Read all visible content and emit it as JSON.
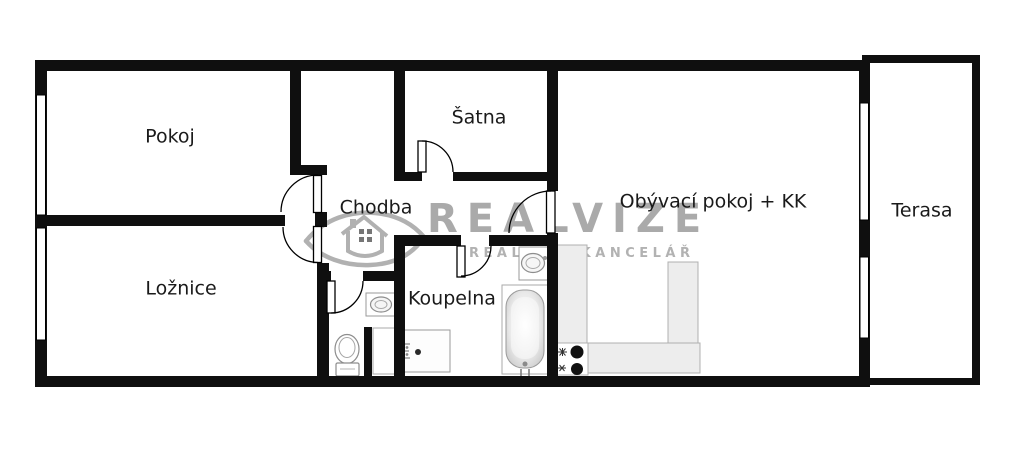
{
  "title": "Apartment floor plan",
  "watermark": {
    "brand": "REALVIZE",
    "tagline": "REALITNÍ KANCELÁŘ",
    "logo": "eye-house-logo",
    "brand_color": "#9c9c9c",
    "tagline_color": "#b2b2b2"
  },
  "rooms": [
    {
      "id": "pokoj",
      "label": "Pokoj"
    },
    {
      "id": "satna",
      "label": "Šatna"
    },
    {
      "id": "chodba",
      "label": "Chodba"
    },
    {
      "id": "loznice",
      "label": "Ložnice"
    },
    {
      "id": "koupelna",
      "label": "Koupelna"
    },
    {
      "id": "obyvaci",
      "label": "Obývací pokoj + KK"
    },
    {
      "id": "terasa",
      "label": "Terasa"
    }
  ],
  "fixtures": [
    "bathtub",
    "shower-tray",
    "washbasin-bathroom",
    "washbasin-wc",
    "toilet",
    "appliance-niche",
    "kitchen-counter-l-shape",
    "stove-two-burners",
    "door-swing-arcs",
    "windows"
  ],
  "colors": {
    "wall": "#0f0f0f",
    "floor": "#ffffff",
    "counter_fill": "#ededed",
    "counter_border": "#b0b0b0",
    "fixture_border": "#909090",
    "label_text": "#1a1a1a"
  }
}
